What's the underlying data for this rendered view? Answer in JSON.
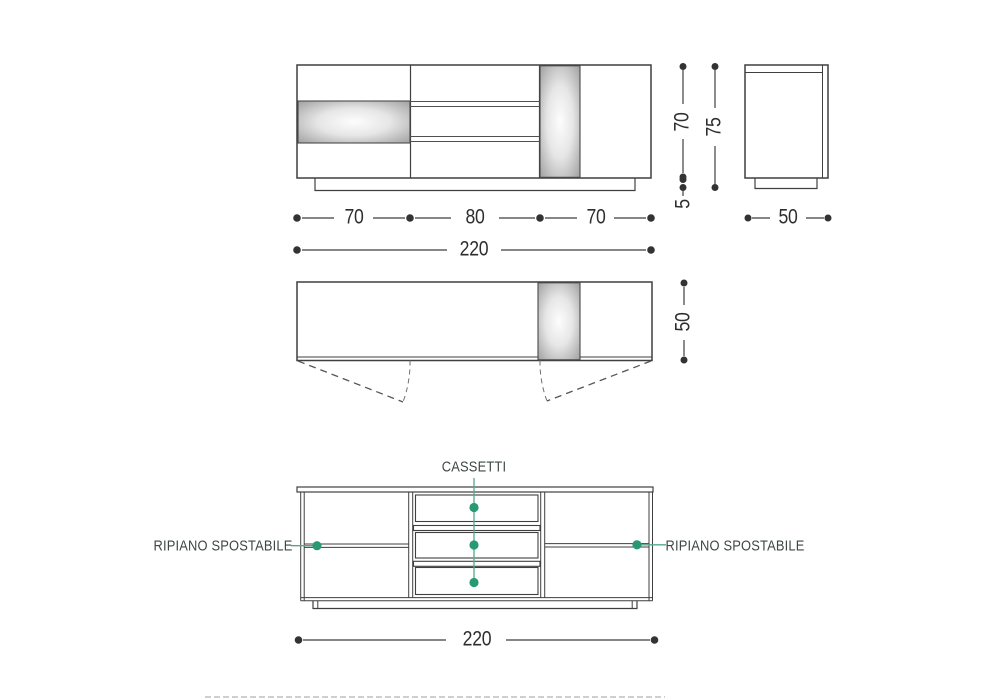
{
  "front_view": {
    "dim_left": "70",
    "dim_center": "80",
    "dim_right": "70",
    "dim_total": "220"
  },
  "side_view": {
    "dim_body_height": "70",
    "dim_total_height": "75",
    "dim_plinth_height": "5",
    "dim_depth": "50"
  },
  "plan_view": {
    "dim_depth": "50"
  },
  "internal_view": {
    "drawers_label": "CASSETTI",
    "left_shelf_label": "RIPIANO SPOSTABILE",
    "right_shelf_label": "RIPIANO SPOSTABILE",
    "dim_total": "220"
  },
  "colors": {
    "line": "#3f3f3f",
    "accent_green": "#279a72",
    "accent_green_line": "#54a78c"
  }
}
